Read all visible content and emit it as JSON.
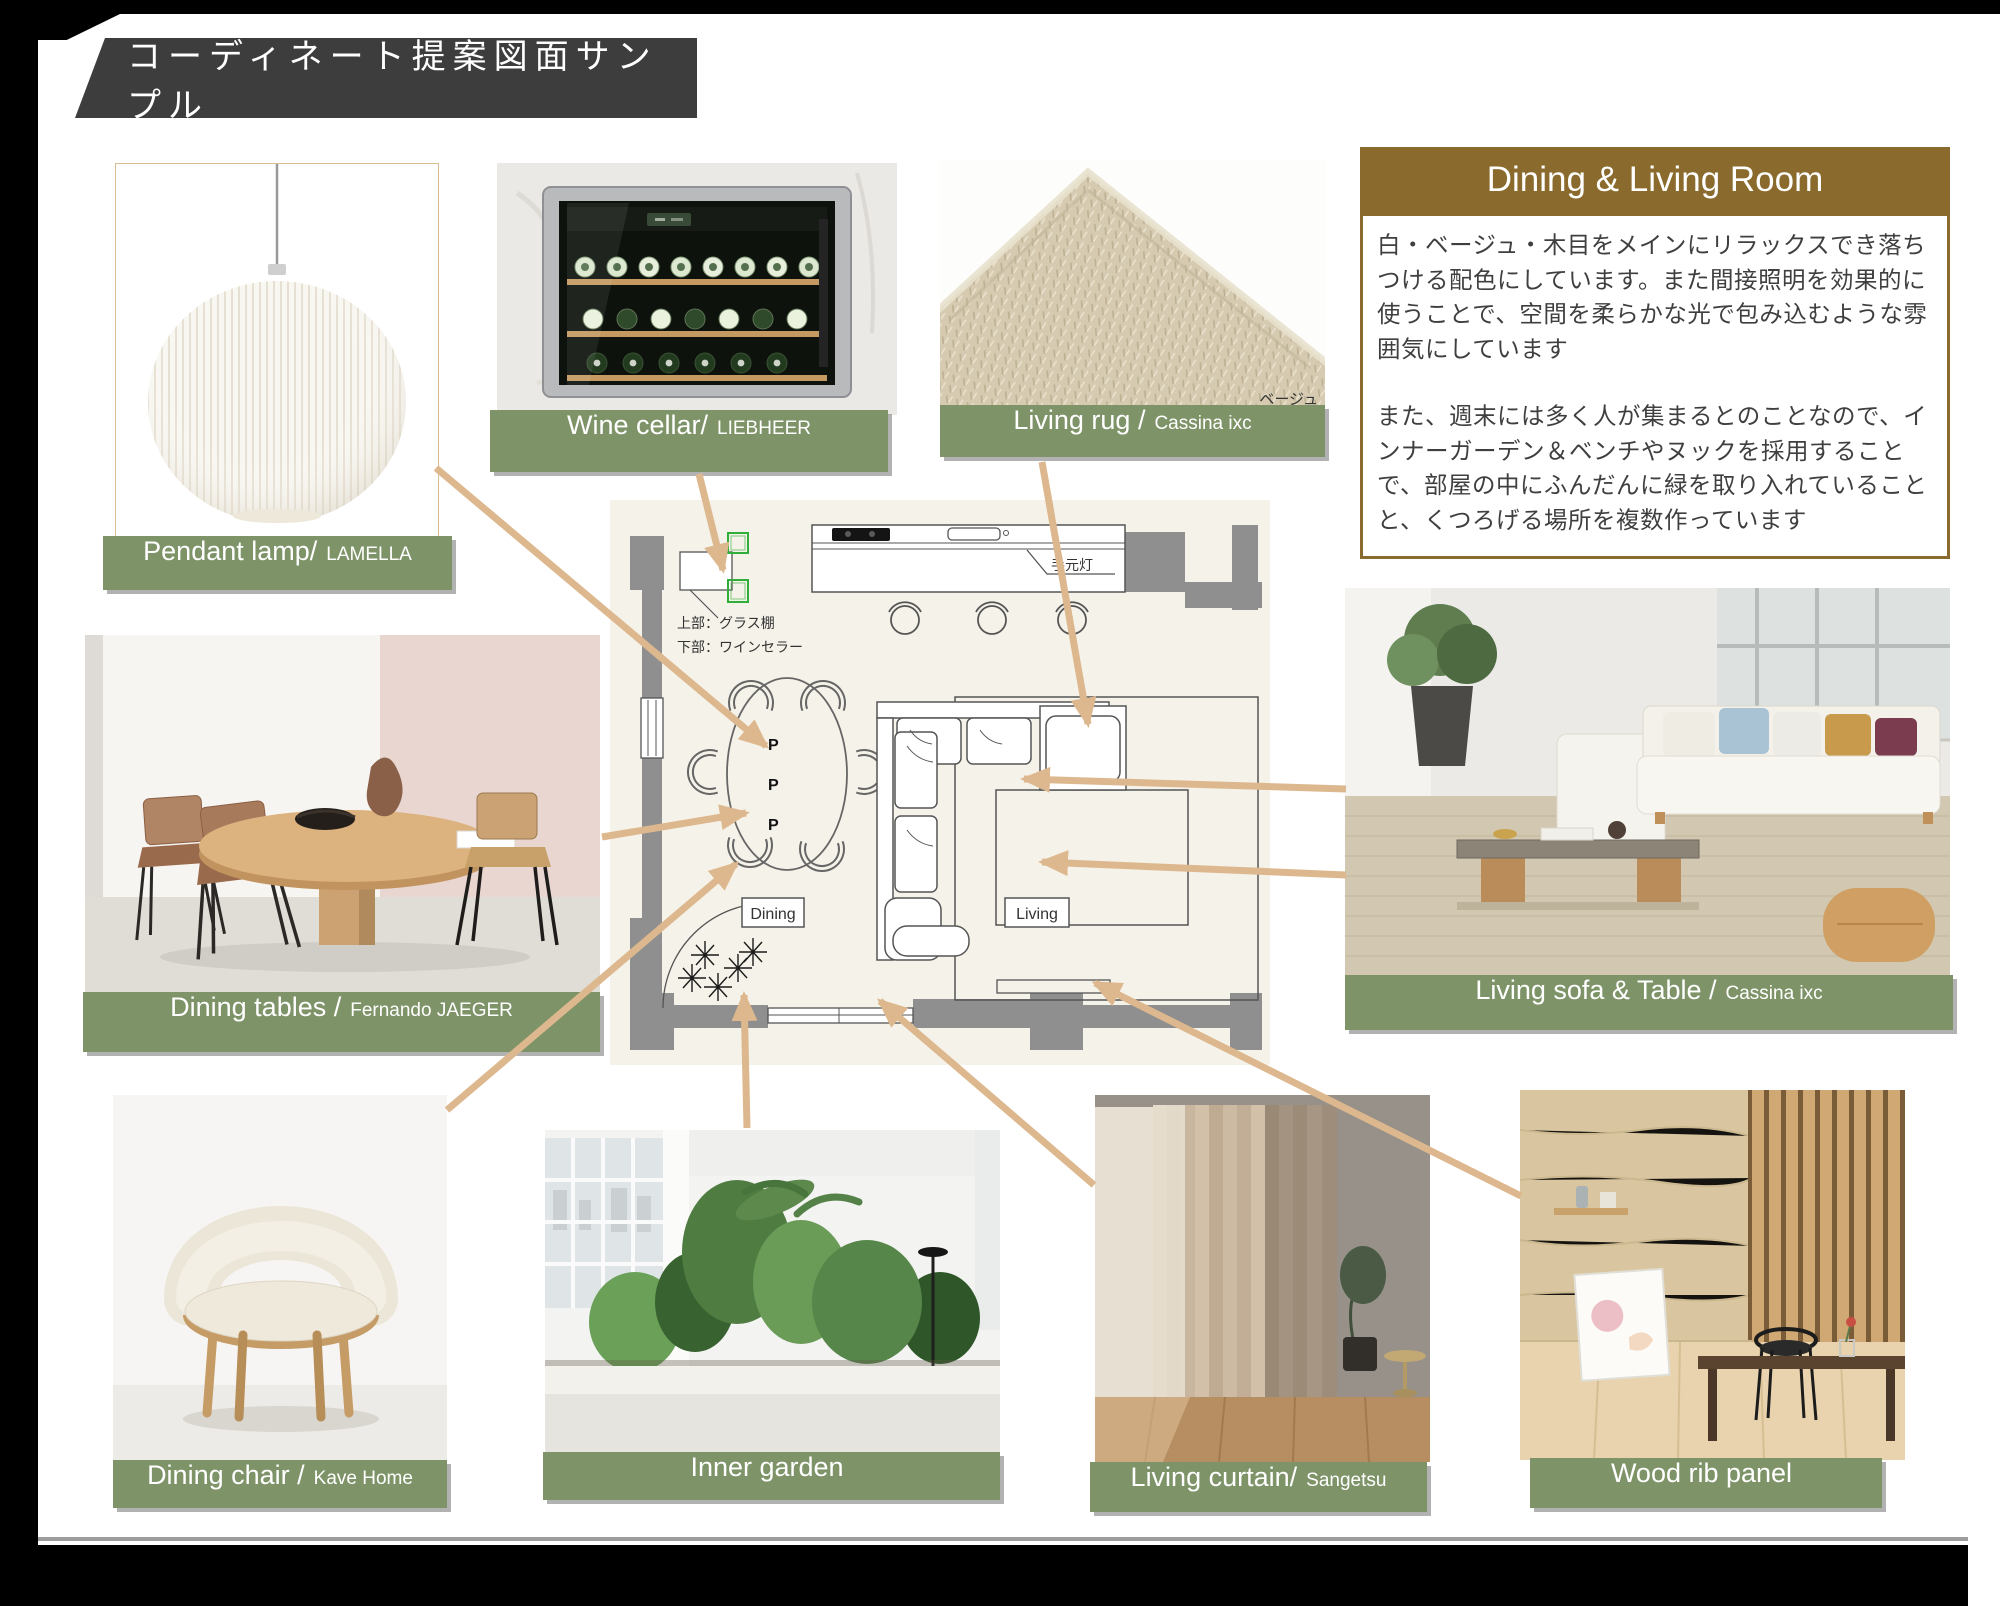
{
  "page": {
    "title": "コーディネート提案図面サンプル"
  },
  "info_panel": {
    "title": "Dining & Living Room",
    "paragraph1": "白・ベージュ・木目をメインにリラックスでき落ちつける配色にしています。また間接照明を効果的に使うことで、空間を柔らかな光で包み込むような雰囲気にしています",
    "paragraph2": "また、週末には多く人が集まるとのことなので、インナーガーデン＆ベンチやヌックを採用することで、部屋の中にふんだんに緑を取り入れていることと、くつろげる場所を複数作っています"
  },
  "products": {
    "pendant_lamp": {
      "label": "Pendant lamp/",
      "brand": "LAMELLA"
    },
    "wine_cellar": {
      "label": "Wine cellar/",
      "brand": "LIEBHEER"
    },
    "living_rug": {
      "label": "Living rug /",
      "brand": "Cassina ixc",
      "color_note": "ベージュ"
    },
    "dining_tables": {
      "label": "Dining tables /",
      "brand": "Fernando JAEGER"
    },
    "living_sofa": {
      "label": "Living sofa & Table /",
      "brand": "Cassina ixc"
    },
    "dining_chair": {
      "label": "Dining chair /",
      "brand": "Kave Home"
    },
    "inner_garden": {
      "label": "Inner garden",
      "brand": ""
    },
    "living_curtain": {
      "label": "Living curtain/",
      "brand": "Sangetsu"
    },
    "wood_rib_panel": {
      "label": "Wood rib panel",
      "brand": ""
    }
  },
  "floor_plan": {
    "dining_label": "Dining",
    "living_label": "Living",
    "hand_light_label": "手元灯",
    "cabinet_note_line1": "上部：グラス棚",
    "cabinet_note_line2": "下部：ワインセラー",
    "pendant_mark": "P"
  },
  "colors": {
    "label_green": "#7E9468",
    "header_brown": "#8A6B2D",
    "arrow_tan": "#DDB88E",
    "banner_gray": "#3D3D3D"
  }
}
